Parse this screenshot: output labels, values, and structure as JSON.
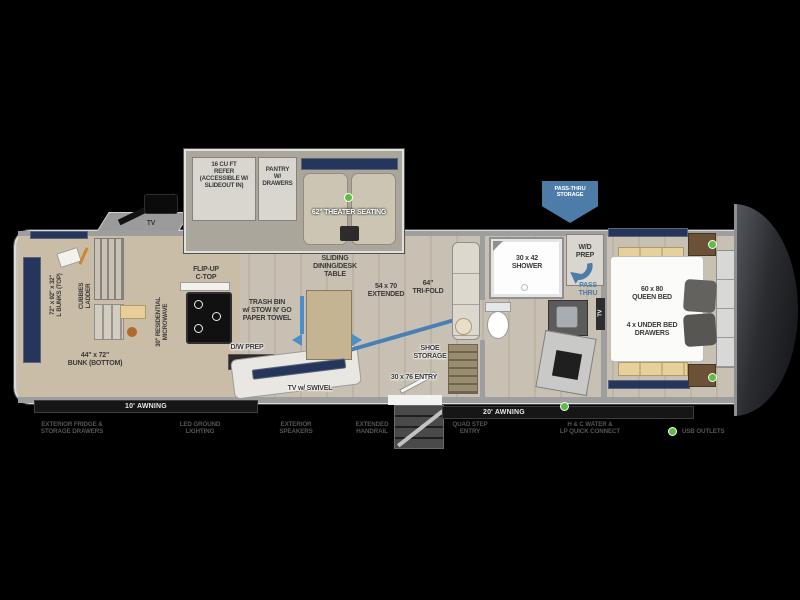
{
  "colors": {
    "accent_blue": "#4d7ca8",
    "usb_green": "#5bc03e",
    "tv_navy": "#25355c",
    "background": "#000000"
  },
  "slide_top": {
    "refer": "16 CU FT\nREFER\n(ACCESSIBLE W/\nSLIDEOUT IN)",
    "pantry": "PANTRY\nW/\nDRAWERS",
    "theater": "62\" THEATER SEATING"
  },
  "banner": {
    "pass_thru_storage": "PASS-THRU\nSTORAGE"
  },
  "bunk_room": {
    "tv": "TV",
    "bunks_top": "72\" x 92\" x 32\"\nL BUNKS (TOP)",
    "cubbies_ladder": "CUBBIES\nLADDER",
    "bunk_bottom": "44\" x 72\"\nBUNK (BOTTOM)"
  },
  "kitchen": {
    "microwave": "30\" RESIDENTIAL\nMICROWAVE",
    "flip_up": "FLIP-UP\nC-TOP",
    "trash": "TRASH BIN\nw/ STOW N' GO\nPAPER TOWEL",
    "dw_prep": "D/W PREP",
    "tv_swivel": "TV w/ SWIVEL"
  },
  "dining": {
    "sliding_table": "SLIDING\nDINING/DESK\nTABLE",
    "extended": "54 x 70\nEXTENDED",
    "trifold": "64\"\nTRI-FOLD",
    "shoe_storage": "SHOE\nSTORAGE",
    "entry": "30 x 76 ENTRY"
  },
  "bathroom": {
    "shower": "30 x 42\nSHOWER",
    "wd_prep": "W/D\nPREP",
    "pass_thru": "PASS\nTHRU",
    "tv": "TV"
  },
  "bedroom": {
    "queen_bed": "60 x 80\nQUEEN BED",
    "under_bed": "4 x UNDER BED\nDRAWERS"
  },
  "awnings": {
    "left": "10' AWNING",
    "right": "20' AWNING"
  },
  "features": [
    "EXTERIOR FRIDGE &\nSTORAGE DRAWERS",
    "LED GROUND\nLIGHTING",
    "EXTERIOR\nSPEAKERS",
    "EXTENDED\nHANDRAIL",
    "QUAD STEP\nENTRY",
    "H & C WATER &\nLP QUICK CONNECT"
  ],
  "legend": {
    "usb_outlets": "USB OUTLETS"
  }
}
